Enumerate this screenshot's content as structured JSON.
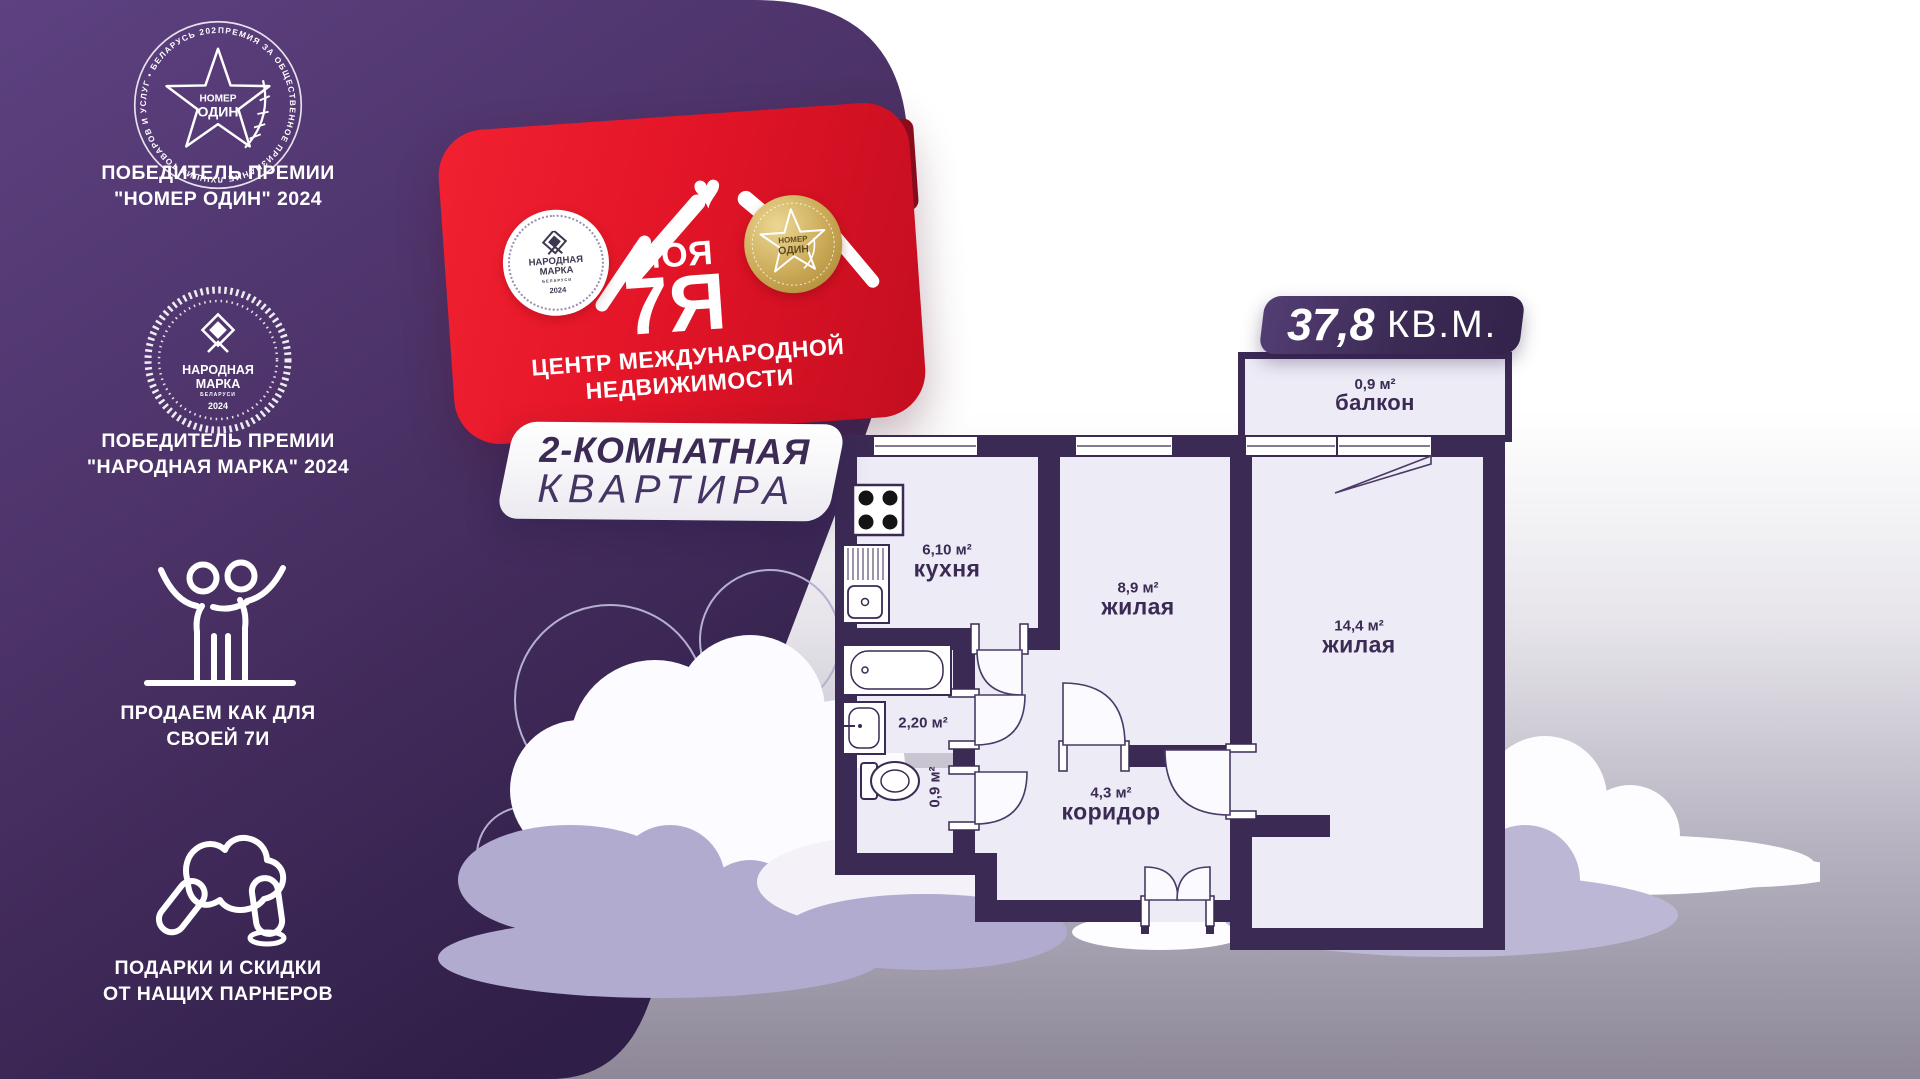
{
  "sidebar": {
    "award1": {
      "ring_text": "ПРЕМИЯ ЗА ОБЩЕСТВЕННОЕ ПРИЗНАНИЕ ЛУЧШИХ ТОВАРОВ И УСЛУГ • БЕЛАРУСЬ 2024 •",
      "badge_line1": "НОМЕР",
      "badge_line2": "ОДИН",
      "caption_line1": "ПОБЕДИТЕЛЬ ПРЕМИИ",
      "caption_line2": "\"НОМЕР ОДИН\" 2024"
    },
    "award2": {
      "badge_line1": "НАРОДНАЯ",
      "badge_line2": "МАРКА",
      "badge_line3": "БЕЛАРУСИ",
      "badge_year": "2024",
      "caption_line1": "ПОБЕДИТЕЛЬ ПРЕМИИ",
      "caption_line2": "\"НАРОДНАЯ МАРКА\" 2024"
    },
    "value1": {
      "caption_line1": "ПРОДАЕМ КАК ДЛЯ",
      "caption_line2": "СВОЕЙ 7И"
    },
    "value2": {
      "caption_line1": "ПОДАРКИ И СКИДКИ",
      "caption_line2": "ОТ НАЩИХ ПАРНЕРОВ"
    }
  },
  "brand": {
    "logo_word1": "МОЯ",
    "logo_word2": "7Я",
    "heart": "♥",
    "tagline_line1": "ЦЕНТР МЕЖДУНАРОДНОЙ",
    "tagline_line2": "НЕДВИЖИМОСТИ",
    "stamp_left": {
      "line1": "НАРОДНАЯ",
      "line2": "МАРКА",
      "sub": "БЕЛАРУСИ",
      "year": "2024"
    },
    "stamp_right": {
      "line1": "НОМЕР",
      "line2": "ОДИН"
    }
  },
  "listing": {
    "type_line1": "2-КОМНАТНАЯ",
    "type_line2": "КВАРТИРА",
    "total_area_value": "37,8",
    "total_area_unit": "КВ.М."
  },
  "floorplan": {
    "balcony": {
      "area": "0,9 м²",
      "name": "балкон"
    },
    "kitchen": {
      "area": "6,10 м²",
      "name": "кухня"
    },
    "room_small": {
      "area": "8,9 м²",
      "name": "жилая"
    },
    "room_large": {
      "area": "14,4 м²",
      "name": "жилая"
    },
    "bathroom": {
      "area": "2,20 м²"
    },
    "wc": {
      "area": "0,9 м²"
    },
    "hall": {
      "area": "4,3 м²",
      "name": "коридор"
    }
  },
  "colors": {
    "wall": "#3b2a54",
    "room_fill": "#edebf6",
    "panel_purple": "#4a3165",
    "banner_red": "#e21427",
    "gold": "#c9a855",
    "cloud_lavender": "#b2abd0"
  }
}
